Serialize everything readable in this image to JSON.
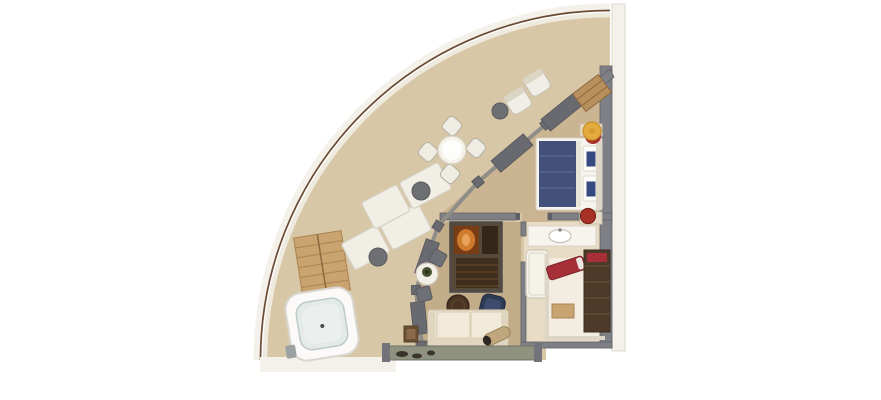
{
  "diagram": {
    "kind": "floor-plan",
    "shape": "quarter-circle-suite",
    "rooms": [
      "balcony",
      "bedroom",
      "living-room",
      "bathroom",
      "walk-in-wardrobe"
    ],
    "furniture": [
      "hot-tub",
      "wooden-deck-steps",
      "sun-lounger",
      "sun-lounger",
      "lounger-side-table",
      "lounger-side-table",
      "dining-table",
      "dining-chair",
      "dining-chair",
      "dining-chair",
      "dining-chair",
      "balcony-armchair",
      "balcony-armchair",
      "balcony-side-table",
      "sliding-glass-doors",
      "double-bed",
      "nightstand",
      "nightstand",
      "yellow-swivel-chair",
      "red-stool",
      "wardrobe-shelves",
      "tv-bar-cabinet",
      "bistro-table",
      "bistro-chair",
      "bistro-chair",
      "sofa",
      "navy-armchair",
      "round-ottoman",
      "bolster-cushion",
      "side-table",
      "vanity-with-sink",
      "shower",
      "red-chaise",
      "wardrobe",
      "closet-bench"
    ]
  },
  "palette": {
    "background": "#ffffff",
    "outer_band": "#f4f1ea",
    "hull_line": "#6a4b33",
    "inner_band": "#efeade",
    "deck": "#d8c7a7",
    "carpet_bedroom": "#cbb492",
    "carpet_living": "#c3ac88",
    "bath_floor": "#e9dcc4",
    "closet_floor": "#f3ede1",
    "wall": "#7f8086",
    "wall_dark": "#5f6065",
    "door_panel": "#696a70",
    "glass_line": "#8e8d88",
    "wood": "#c9a470",
    "wood_shelf": "#b8905e",
    "wood_dark": "#4e3a29",
    "cabinet_body": "#55493c",
    "cabinet_glow": "#cf7b2e",
    "bed_frame": "#f6f4ef",
    "bed_blanket": "#42507a",
    "pillow_blue": "#34497e",
    "sofa": "#eae1cf",
    "cushion": "#f1e9d9",
    "armchair_navy": "#2e3a53",
    "ottoman": "#4a3524",
    "tub_shell": "#fbfaf8",
    "tub_water": "#e3eae8",
    "lounger": "#f1eee5",
    "chair_white": "#eeece3",
    "chair_yellow": "#e3ab3d",
    "accent_red": "#a83228",
    "chaise_red": "#a62f38",
    "ledge": "#8e927e",
    "side_table_gray": "#6e6f73",
    "plant_green": "#44502f",
    "bolster_tan": "#bfa67c"
  }
}
